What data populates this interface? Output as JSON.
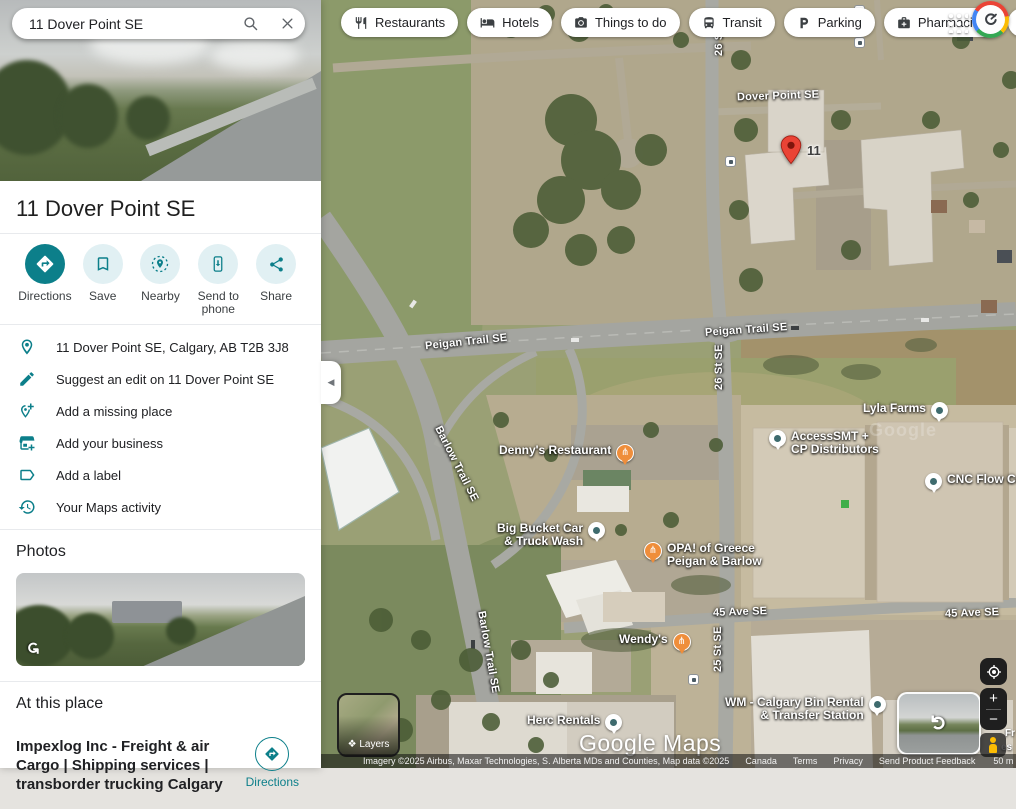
{
  "search": {
    "value": "11 Dover Point SE"
  },
  "topbar": {
    "chips": [
      {
        "label": "Restaurants"
      },
      {
        "label": "Hotels"
      },
      {
        "label": "Things to do"
      },
      {
        "label": "Transit"
      },
      {
        "label": "Parking"
      },
      {
        "label": "Pharmacies"
      },
      {
        "label": "ATM"
      }
    ],
    "more_label": "›"
  },
  "place": {
    "title": "11 Dover Point SE",
    "actions": [
      {
        "label": "Directions"
      },
      {
        "label": "Save"
      },
      {
        "label": "Nearby"
      },
      {
        "label": "Send to phone"
      },
      {
        "label": "Share"
      }
    ],
    "info_rows": [
      "11 Dover Point SE, Calgary, AB T2B 3J8",
      "Suggest an edit on 11 Dover Point SE",
      "Add a missing place",
      "Add your business",
      "Add a label",
      "Your Maps activity"
    ],
    "photos_heading": "Photos",
    "at_this_place_heading": "At this place",
    "business_name": "Impexlog Inc - Freight & air Cargo | Shipping services | transborder trucking Calgary",
    "business_directions_label": "Directions"
  },
  "map": {
    "marker_label": "11",
    "road_labels": [
      "Dover Point SE",
      "26 St SE",
      "Peigan Trail SE",
      "Peigan Trail SE",
      "26 St SE",
      "Barlow Trail SE",
      "Barlow Trail SE",
      "45 Ave SE",
      "45 Ave SE",
      "25 St SE"
    ],
    "pois": [
      {
        "name": "Denny's Restaurant"
      },
      {
        "line1": "Big Bucket Car",
        "line2": "& Truck Wash"
      },
      {
        "line1": "OPA! of Greece",
        "line2": "Peigan & Barlow"
      },
      {
        "name": "Wendy's"
      },
      {
        "name": "Herc Rentals"
      },
      {
        "line1": "WM - Calgary Bin Rental",
        "line2": "& Transfer Station"
      },
      {
        "name": "Lyla Farms"
      },
      {
        "line1": "AccessSMT +",
        "line2": "CP Distributors"
      },
      {
        "name": "CNC Flow Co"
      }
    ],
    "ghost_watermark": "Google",
    "watermark": "Google Maps",
    "fragments": [
      "Fr",
      "es"
    ],
    "controls": {
      "layers_label": "Layers",
      "zoom_in": "+",
      "zoom_out": "−",
      "collapse": "◀"
    },
    "attribution": {
      "imagery": "Imagery ©2025 Airbus, Maxar Technologies, S. Alberta MDs and Counties, Map data ©2025",
      "links": [
        "Canada",
        "Terms",
        "Privacy",
        "Send Product Feedback"
      ],
      "scale": "50 m"
    }
  },
  "colors": {
    "accent_teal": "#0c7f8a",
    "pin_red": "#ea4335",
    "poi_orange": "#ef8e3b"
  }
}
